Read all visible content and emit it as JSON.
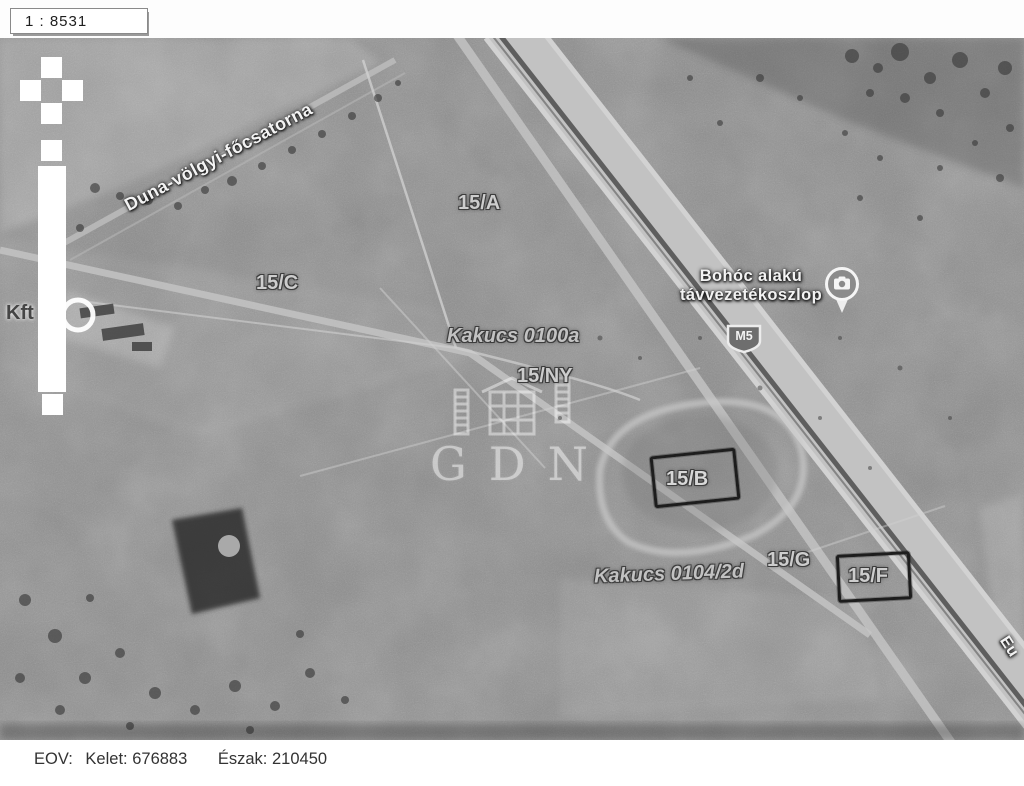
{
  "scale_indicator": {
    "value": "1 : 8531"
  },
  "map": {
    "parcels": {
      "a": "15/A",
      "c": "15/C",
      "ny": "15/NY",
      "b": "15/B",
      "g": "15/G",
      "f": "15/F"
    },
    "places": {
      "canal": "Duna-völgyi-főcsatorna",
      "parcel_0100a": "Kakucs 0100a",
      "parcel_0104_2d": "Kakucs 0104/2d",
      "company": "Kft",
      "road_name_clipped": "Eu"
    },
    "poi_photo": {
      "label_line1": "Bohóc alakú",
      "label_line2": "távvezetékoszlop",
      "icon": "camera-photo-pin"
    },
    "road_shield": {
      "value": "M5"
    },
    "watermark": {
      "value": "GDN",
      "icon": "gdn-building-logo"
    },
    "marked_parcel_boxes": [
      "15/B",
      "15/F"
    ]
  },
  "footer": {
    "eov_label": "EOV:",
    "east_label": "Kelet:",
    "east_value": "676883",
    "north_label": "Észak:",
    "north_value": "210450"
  },
  "colors": {
    "photo_base": "#8d8d8d",
    "motorway_band": "#c2c2c2",
    "label_white": "#f3f3f3",
    "label_cadastral": "#cdcdcd",
    "drawn_box": "#1d1d1d"
  }
}
